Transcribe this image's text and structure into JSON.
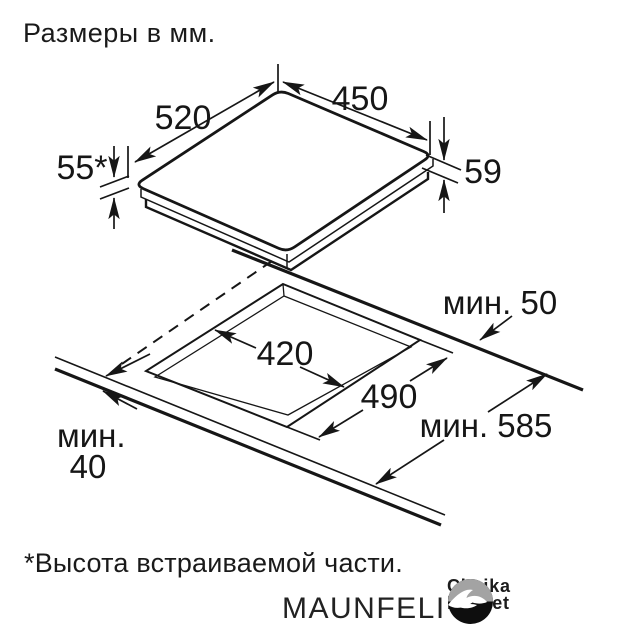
{
  "header": {
    "title": "Размеры в мм."
  },
  "diagram": {
    "appliance": {
      "width_label": "520",
      "depth_label": "450",
      "builtin_height_label": "55*",
      "total_height_label": "59"
    },
    "cutout": {
      "width_label": "420",
      "depth_label": "490"
    },
    "worktop": {
      "rear_clearance_label": "мин. 50",
      "depth_label": "мин. 585",
      "front_clearance_word": "мин.",
      "front_clearance_value": "40"
    }
  },
  "footnote": {
    "text": "*Высота встраиваемой части."
  },
  "footer": {
    "brand": "MAUNFELI",
    "logo_line1": "Chaika",
    "logo_line2": "Market"
  },
  "colors": {
    "line": "#161616",
    "background": "#ffffff",
    "logo_gray": "#a3a3a3",
    "logo_black": "#0e0e0e"
  }
}
